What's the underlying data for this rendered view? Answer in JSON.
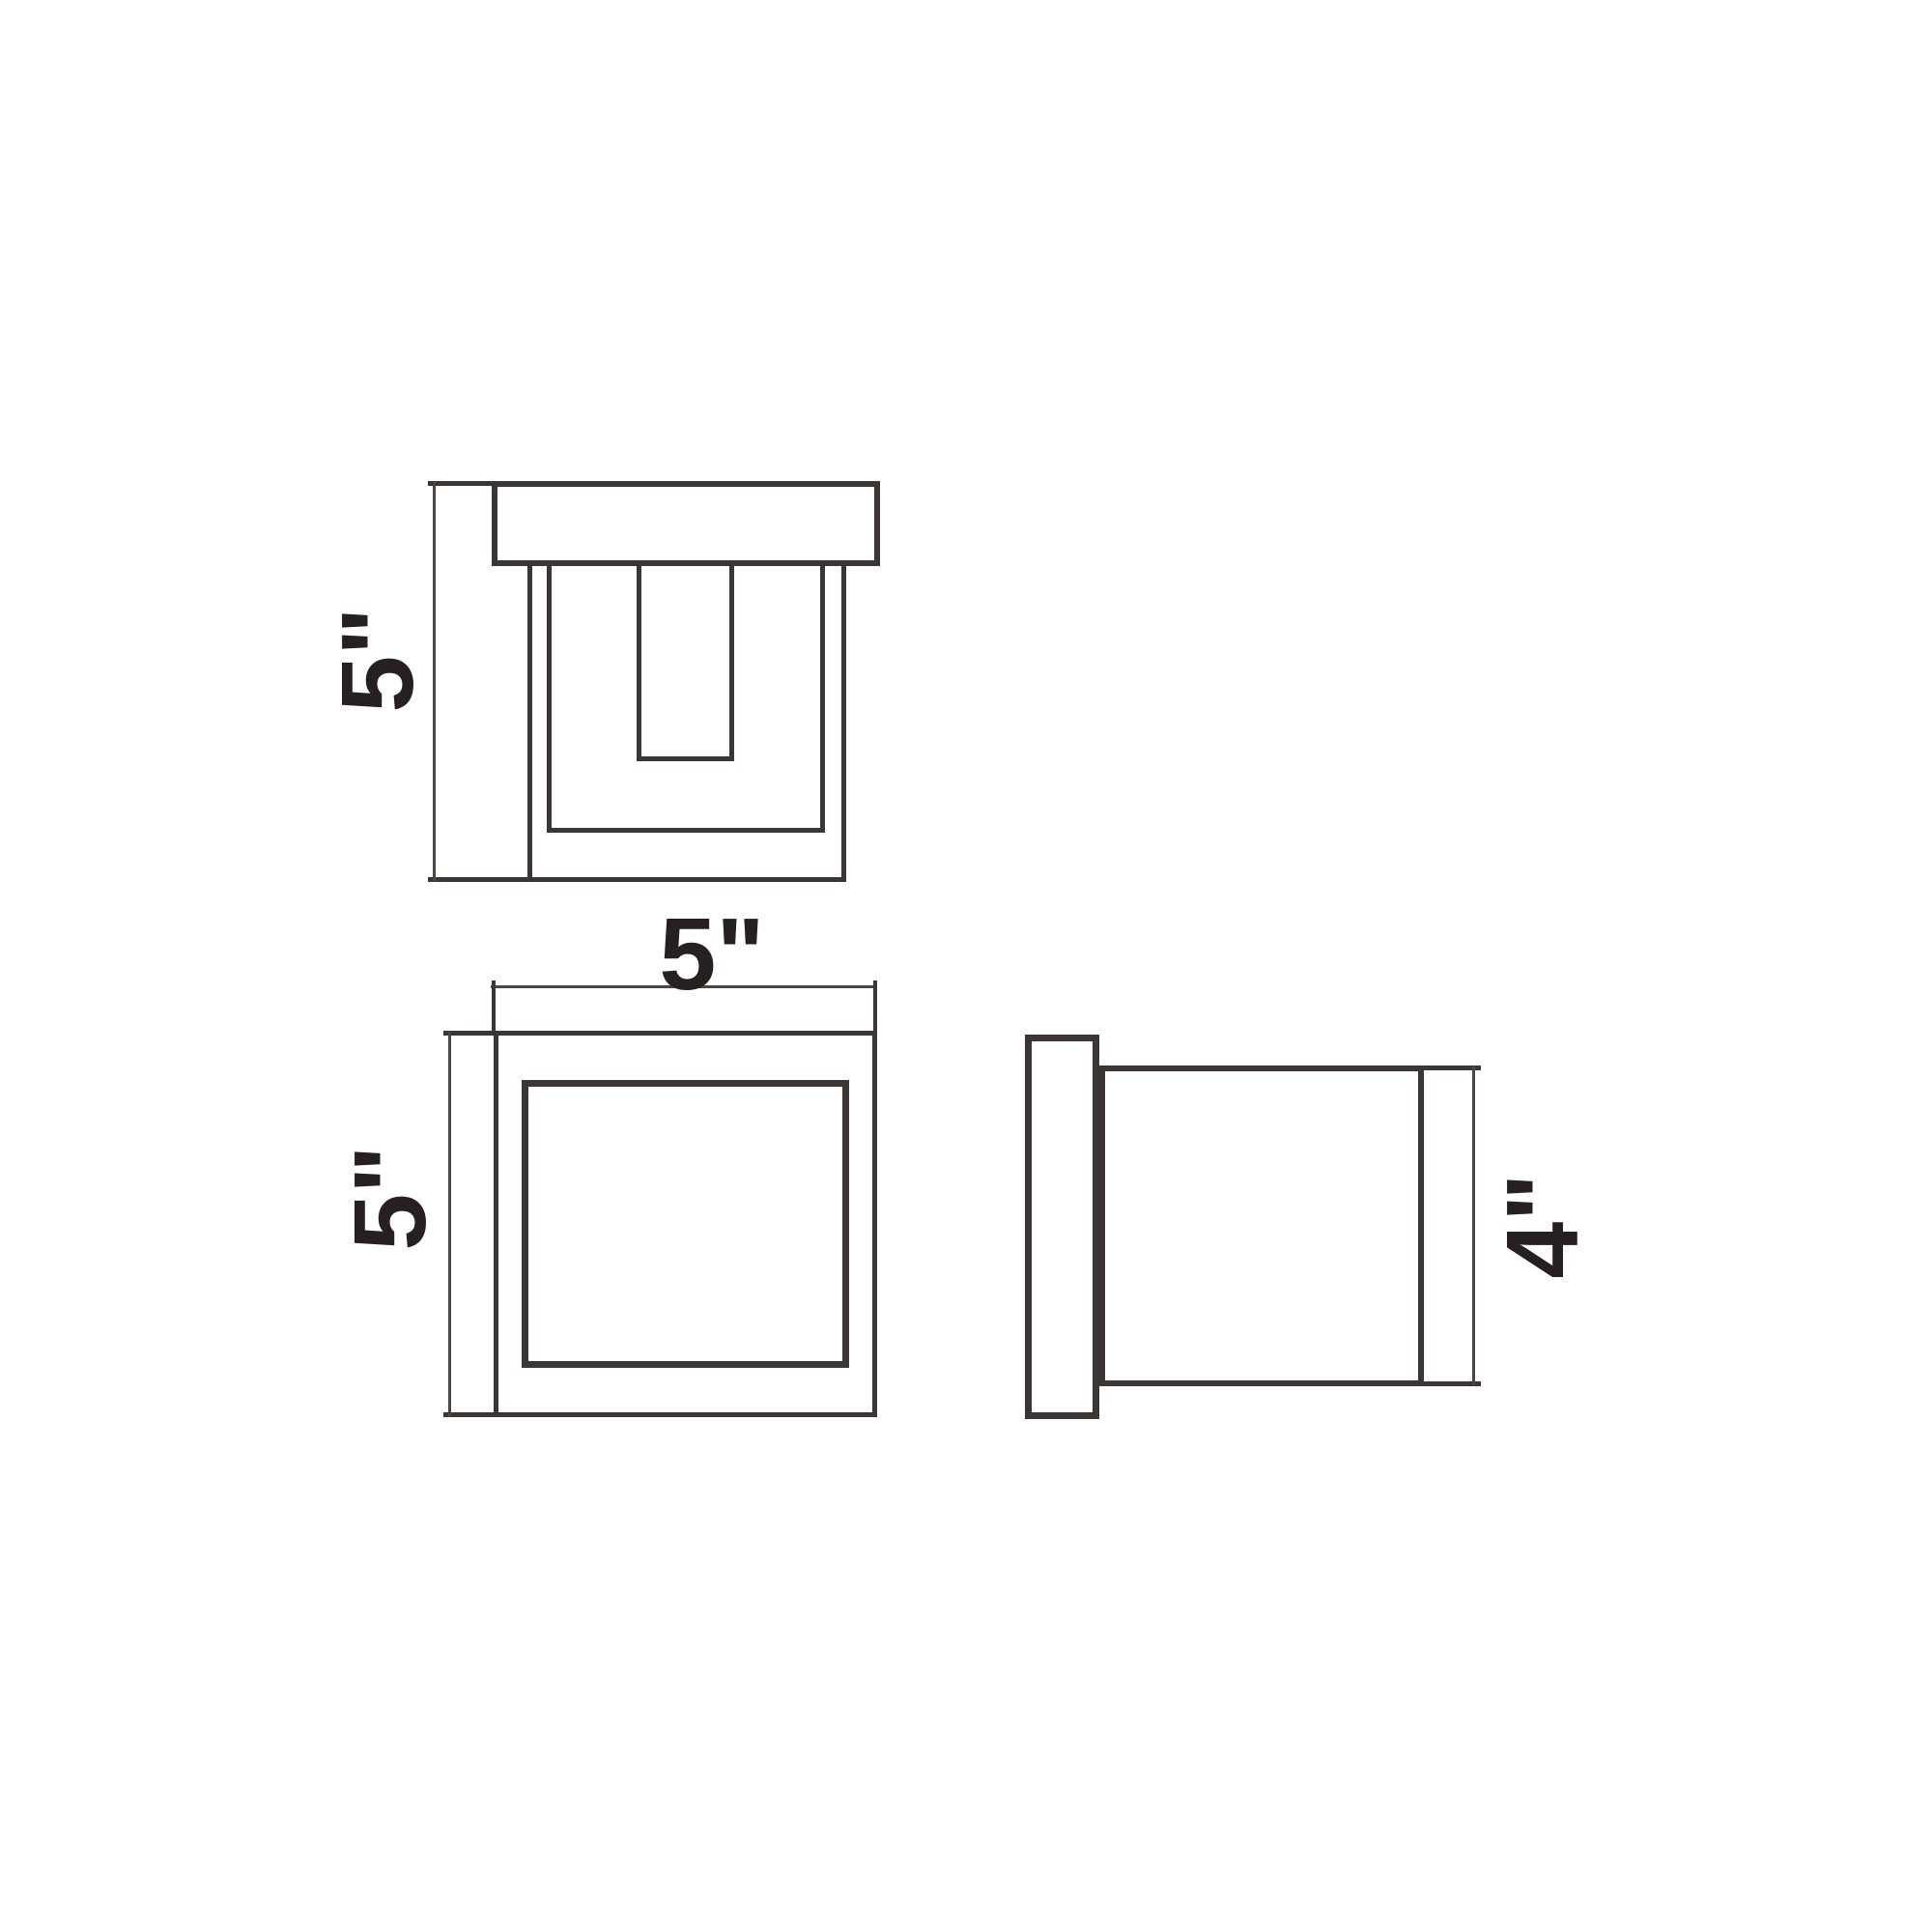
{
  "colors": {
    "background": "#ffffff",
    "line": "#3b3533",
    "dimension_line": "#4c4541",
    "text": "#262120"
  },
  "views": {
    "front": {
      "height_label": "5\""
    },
    "plan": {
      "width_label": "5\"",
      "depth_label": "5\""
    },
    "side": {
      "height_label": "4\""
    }
  }
}
